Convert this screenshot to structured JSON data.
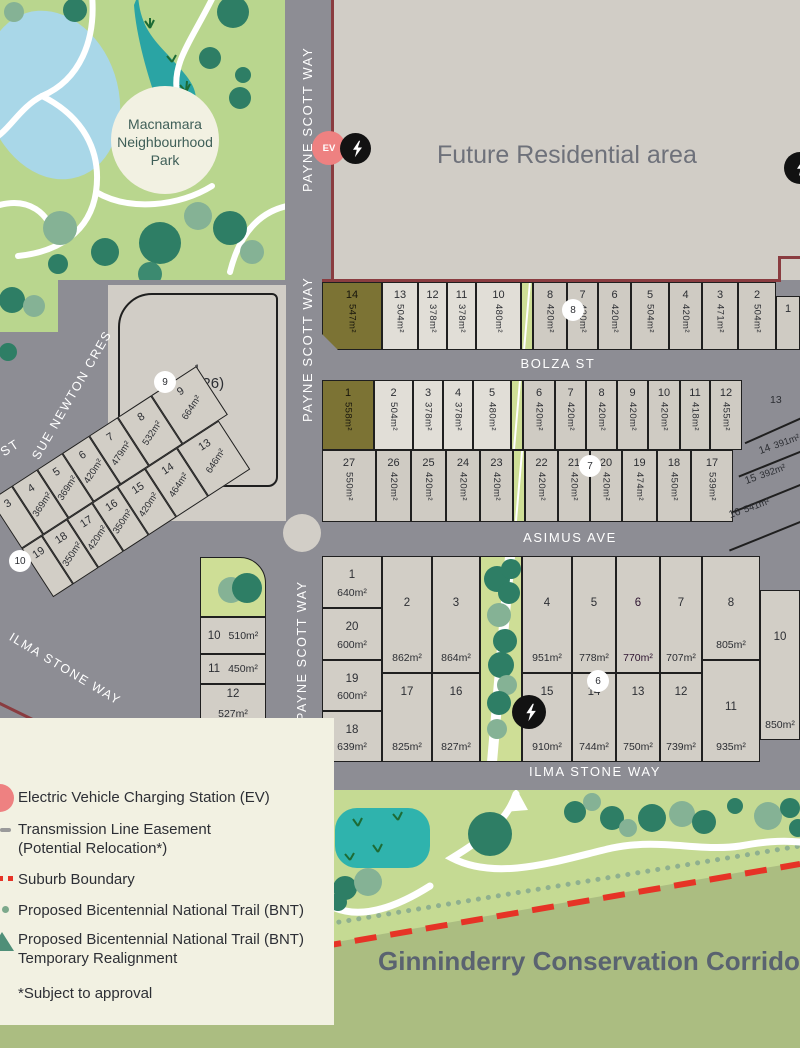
{
  "park": {
    "label": "Macnamara\nNeighbourhood\nPark"
  },
  "future_area": {
    "label": "Future Residential area"
  },
  "corridor": {
    "label": "Ginninderry Conservation Corridor"
  },
  "streets": {
    "payne_scott": "PAYNE SCOTT WAY",
    "bolza": "BOLZA ST",
    "asimus": "ASIMUS AVE",
    "ilma": "ILMA STONE WAY",
    "sue_newton": "SUE NEWTON CRES",
    "partial_st": "ST"
  },
  "mu_block": {
    "number": "1",
    "label": "MU (26)",
    "area": "6,623m²"
  },
  "ev": {
    "label": "EV"
  },
  "rows": {
    "bolza_north": [
      {
        "n": "14",
        "a": "547m²",
        "c": "olive",
        "w": 60,
        "clip": true
      },
      {
        "n": "13",
        "a": "504m²",
        "c": "light",
        "w": 36
      },
      {
        "n": "12",
        "a": "378m²",
        "c": "light",
        "w": 29
      },
      {
        "n": "11",
        "a": "378m²",
        "c": "light",
        "w": 29
      },
      {
        "n": "10",
        "a": "480m²",
        "c": "light",
        "w": 45
      },
      {
        "strip": true,
        "w": 12
      },
      {
        "n": "8",
        "a": "420m²",
        "c": "dark",
        "w": 34
      },
      {
        "n": "7",
        "a": "420m²",
        "c": "dark",
        "w": 31
      },
      {
        "n": "6",
        "a": "420m²",
        "c": "dark",
        "w": 33
      },
      {
        "n": "5",
        "a": "504m²",
        "c": "dark",
        "w": 38
      },
      {
        "n": "4",
        "a": "420m²",
        "c": "dark",
        "w": 33
      },
      {
        "n": "3",
        "a": "471m²",
        "c": "dark",
        "w": 36
      },
      {
        "n": "2",
        "a": "504m²",
        "c": "dark",
        "w": 38
      },
      {
        "n": "1",
        "a": "",
        "c": "dark",
        "w": 24,
        "short": true
      }
    ],
    "bolza_south": [
      {
        "n": "1",
        "a": "558m²",
        "c": "olive",
        "w": 52
      },
      {
        "n": "2",
        "a": "504m²",
        "c": "light",
        "w": 39
      },
      {
        "n": "3",
        "a": "378m²",
        "c": "light",
        "w": 30
      },
      {
        "n": "4",
        "a": "378m²",
        "c": "light",
        "w": 30
      },
      {
        "n": "5",
        "a": "480m²",
        "c": "light",
        "w": 38
      },
      {
        "strip": true,
        "w": 12
      },
      {
        "n": "6",
        "a": "420m²",
        "c": "dark",
        "w": 32
      },
      {
        "n": "7",
        "a": "420m²",
        "c": "dark",
        "w": 31
      },
      {
        "n": "8",
        "a": "420m²",
        "c": "dark",
        "w": 31
      },
      {
        "n": "9",
        "a": "420m²",
        "c": "dark",
        "w": 31
      },
      {
        "n": "10",
        "a": "420m²",
        "c": "dark",
        "w": 32
      },
      {
        "n": "11",
        "a": "418m²",
        "c": "dark",
        "w": 30
      },
      {
        "n": "12",
        "a": "455m²",
        "c": "dark",
        "w": 32
      }
    ],
    "asimus_north": [
      {
        "n": "27",
        "a": "550m²",
        "c": "dark",
        "w": 54
      },
      {
        "n": "26",
        "a": "420m²",
        "c": "dark",
        "w": 35
      },
      {
        "n": "25",
        "a": "420m²",
        "c": "dark",
        "w": 35
      },
      {
        "n": "24",
        "a": "420m²",
        "c": "dark",
        "w": 34
      },
      {
        "n": "23",
        "a": "420m²",
        "c": "dark",
        "w": 33
      },
      {
        "strip": true,
        "w": 12
      },
      {
        "n": "22",
        "a": "420m²",
        "c": "dark",
        "w": 33
      },
      {
        "n": "21",
        "a": "420m²",
        "c": "dark",
        "w": 32
      },
      {
        "n": "20",
        "a": "420m²",
        "c": "dark",
        "w": 32
      },
      {
        "n": "19",
        "a": "474m²",
        "c": "dark",
        "w": 35
      },
      {
        "n": "18",
        "a": "450m²",
        "c": "dark",
        "w": 34
      },
      {
        "n": "17",
        "a": "539m²",
        "c": "dark",
        "w": 42
      }
    ]
  },
  "corner_lots": [
    {
      "n": "13",
      "a": "",
      "x": 770,
      "y": 394,
      "r": 0
    },
    {
      "n": "14",
      "a": "391m²",
      "x": 758,
      "y": 438,
      "r": -20
    },
    {
      "n": "15",
      "a": "392m²",
      "x": 744,
      "y": 468,
      "r": -20
    },
    {
      "n": "16",
      "a": "541m²",
      "x": 728,
      "y": 502,
      "r": -20
    }
  ],
  "bottom_block": {
    "cols": [
      {
        "w": 60,
        "cells": [
          {
            "n": "1",
            "a": "640m²",
            "h": 52
          },
          {
            "n": "20",
            "a": "600m²",
            "h": 52
          },
          {
            "n": "19",
            "a": "600m²",
            "h": 51
          },
          {
            "n": "18",
            "a": "639m²",
            "h": 51
          }
        ]
      },
      {
        "w": 50,
        "cells": [
          {
            "n": "2",
            "a": "862m²",
            "h": 117
          },
          {
            "n": "17",
            "a": "825m²",
            "h": 89
          }
        ]
      },
      {
        "w": 48,
        "cells": [
          {
            "n": "3",
            "a": "864m²",
            "h": 117
          },
          {
            "n": "16",
            "a": "827m²",
            "h": 89
          }
        ]
      },
      {
        "w": 42,
        "strip": true
      },
      {
        "w": 50,
        "cells": [
          {
            "n": "4",
            "a": "951m²",
            "h": 117
          },
          {
            "n": "15",
            "a": "910m²",
            "h": 89
          }
        ]
      },
      {
        "w": 44,
        "cells": [
          {
            "n": "5",
            "a": "778m²",
            "h": 117
          },
          {
            "n": "14",
            "a": "744m²",
            "h": 89
          }
        ]
      },
      {
        "w": 44,
        "cells": [
          {
            "n": "6",
            "a": "770m²",
            "c": "magenta",
            "h": 117
          },
          {
            "n": "13",
            "a": "750m²",
            "h": 89
          }
        ]
      },
      {
        "w": 42,
        "cells": [
          {
            "n": "7",
            "a": "707m²",
            "h": 117
          },
          {
            "n": "12",
            "a": "739m²",
            "h": 89
          }
        ]
      },
      {
        "w": 58,
        "cells": [
          {
            "n": "8",
            "a": "805m²",
            "h": 104
          },
          {
            "n": "11",
            "a": "935m²",
            "h": 102
          }
        ]
      },
      {
        "w": 40,
        "cells": [
          {
            "n": "10",
            "a": "850m²",
            "h": 150,
            "off": 34
          }
        ]
      }
    ]
  },
  "west_block": {
    "row_upper": [
      {
        "n": "3",
        "a": "",
        "w": 26
      },
      {
        "n": "4",
        "a": "369m²",
        "w": 30
      },
      {
        "n": "5",
        "a": "369m²",
        "w": 30
      },
      {
        "n": "6",
        "a": "420m²",
        "w": 32
      },
      {
        "n": "7",
        "a": "479m²",
        "w": 34
      },
      {
        "n": "8",
        "a": "532m²",
        "w": 40
      },
      {
        "n": "9",
        "a": "664m²",
        "w": 54
      }
    ],
    "row_lower": [
      {
        "n": "19",
        "a": "",
        "w": 24
      },
      {
        "n": "18",
        "a": "350m²",
        "w": 30
      },
      {
        "n": "17",
        "a": "420m²",
        "w": 30
      },
      {
        "n": "16",
        "a": "350m²",
        "w": 30
      },
      {
        "n": "15",
        "a": "420m²",
        "w": 33
      },
      {
        "n": "14",
        "a": "464m²",
        "w": 38
      },
      {
        "n": "13",
        "a": "646m²",
        "w": 50
      }
    ],
    "stack": [
      {
        "n": "10",
        "a": "510m²",
        "h": 37
      },
      {
        "n": "11",
        "a": "450m²",
        "h": 30
      },
      {
        "n": "12",
        "a": "527m²",
        "h": 40
      }
    ]
  },
  "markers": [
    {
      "n": "9",
      "x": 154,
      "y": 371
    },
    {
      "n": "8",
      "x": 562,
      "y": 299
    },
    {
      "n": "7",
      "x": 579,
      "y": 455
    },
    {
      "n": "10",
      "x": 9,
      "y": 550
    },
    {
      "n": "6",
      "x": 587,
      "y": 670
    }
  ],
  "legend": {
    "items": [
      {
        "icon": "ev-circle",
        "line1": "Electric Vehicle Charging Station (EV)",
        "line2": ""
      },
      {
        "icon": "gray-dash",
        "line1": "Transmission Line Easement",
        "line2": "(Potential Relocation*)"
      },
      {
        "icon": "red-dashes",
        "line1": "Suburb Boundary",
        "line2": ""
      },
      {
        "icon": "green-dot",
        "line1": "Proposed Bicentennial National Trail (BNT)",
        "line2": ""
      },
      {
        "icon": "green-triangle",
        "line1": "Proposed Bicentennial National Trail (BNT)",
        "line2": "Temporary Realignment"
      }
    ],
    "footnote": "*Subject to approval"
  },
  "colors": {
    "road": "#8d8d94",
    "lot_light": "#e1ded7",
    "lot_dark": "#cfcbc3",
    "olive": "#7c7334",
    "magenta": "#b955ad",
    "strip_green": "#cede96",
    "park_green": "#b9d68e",
    "corridor_light": "#c5da93",
    "corridor_dark": "#abbd81",
    "legend_bg": "#f2f1e2",
    "suburb_maroon": "#8a3c40",
    "boundary_red": "#e63326",
    "ev_pink": "#ee8181",
    "pond_blue": "#a9d7e8",
    "stream_teal": "#2aa4a4",
    "tree_dark": "#2e7e65",
    "tree_sage": "#85b295"
  }
}
